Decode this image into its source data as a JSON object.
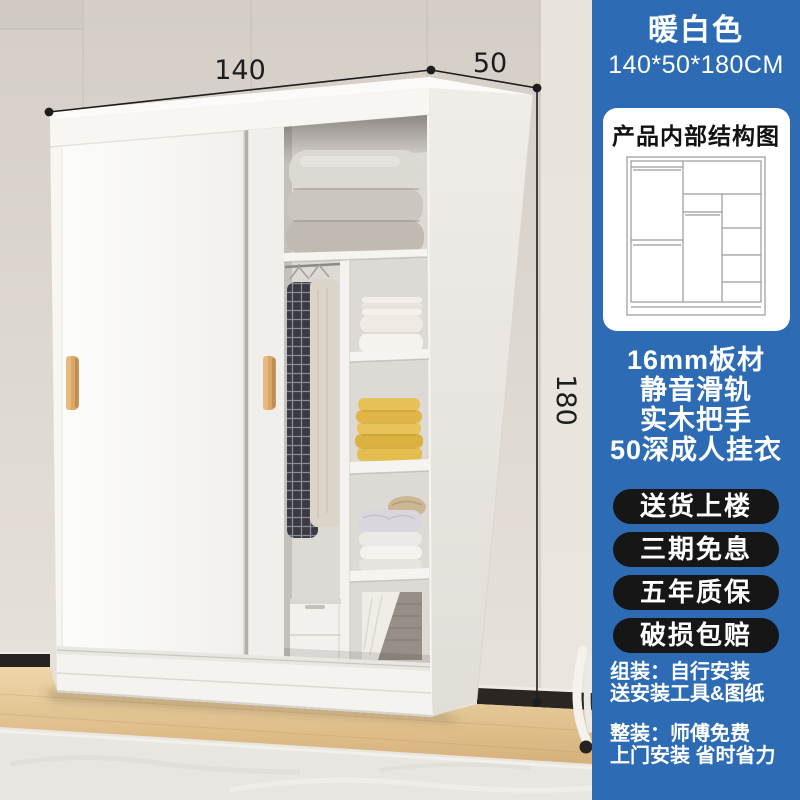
{
  "scene": {
    "dimension_labels": {
      "width": "140",
      "depth": "50",
      "height": "180"
    }
  },
  "sidebar": {
    "color_name": "暖白色",
    "size_text": "140*50*180CM",
    "structure_card_title": "产品内部结构图",
    "features": [
      "16mm板材",
      "静音滑轨",
      "实木把手",
      "50深成人挂衣"
    ],
    "service_badges": [
      "送货上楼",
      "三期免息",
      "五年质保",
      "破损包赔"
    ],
    "notes": [
      "组装：自行安装",
      "送安装工具&图纸",
      "整装：师傅免费",
      "上门安装 省时省力"
    ]
  },
  "colors": {
    "sidebar_blue": "#2d6cb4",
    "badge_dark": "#161616",
    "handle_wood": "#d9a766",
    "dimension_ink": "#1d1d1d",
    "card_white": "#ffffff"
  }
}
